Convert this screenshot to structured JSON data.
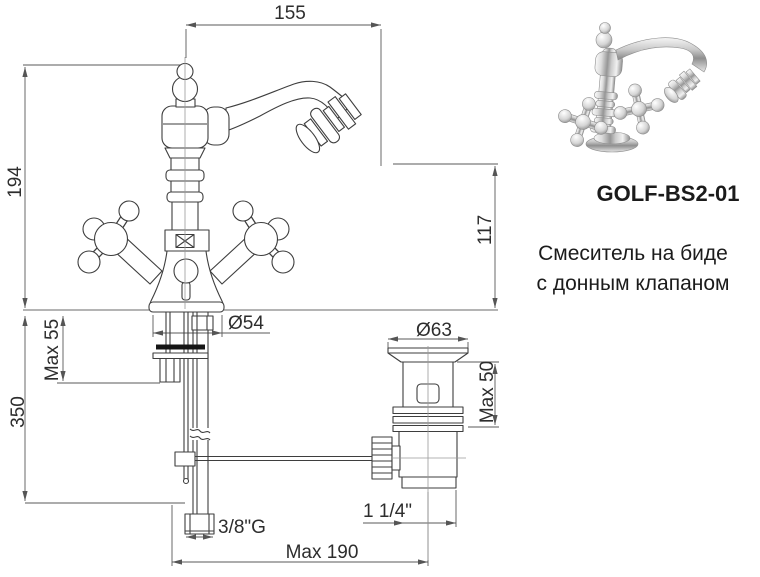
{
  "product": {
    "code": "GOLF-BS2-01",
    "description_line1": "Смеситель на биде",
    "description_line2": "с донным клапаном"
  },
  "drawing": {
    "dimensions": {
      "spout_reach": "155",
      "total_height": "194",
      "spout_height": "117",
      "base_diameter": "Ø54",
      "deck_thickness": "Max 55",
      "supply_length": "350",
      "drain_flange_diameter": "Ø63",
      "drain_deck_thickness": "Max 50",
      "supply_thread": "3/8\"G",
      "drain_thread": "1 1/4\"",
      "drain_offset": "Max 190"
    }
  },
  "colors": {
    "drawing_line": "#3e3e3e",
    "dimension_line": "#555555",
    "text": "#2d2d2d"
  }
}
